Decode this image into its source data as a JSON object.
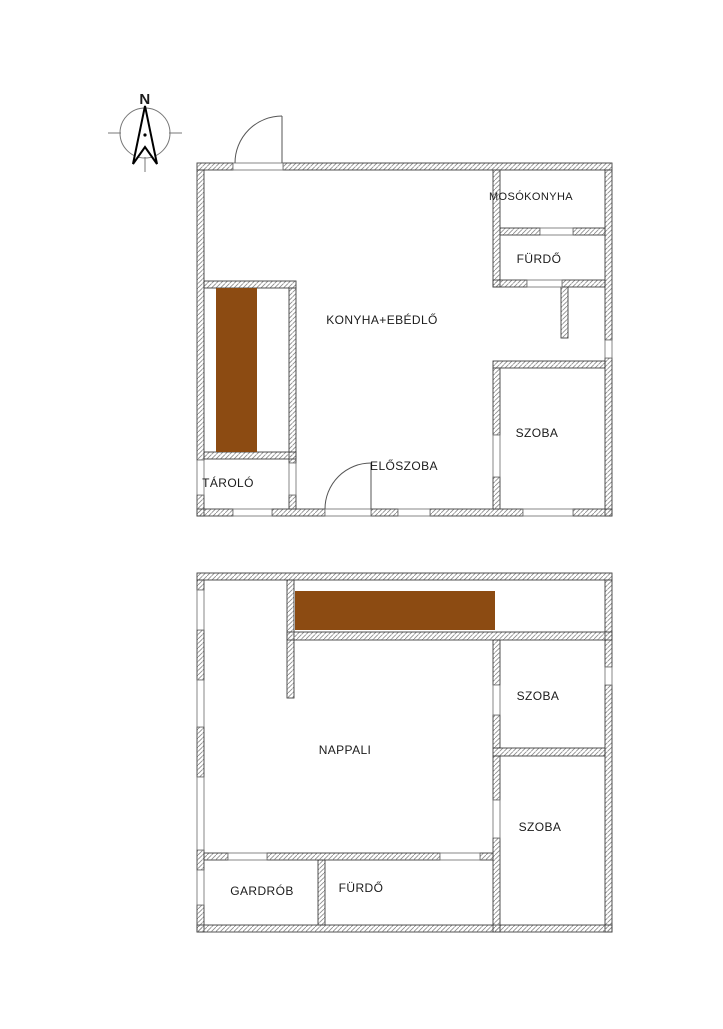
{
  "compass": {
    "north_label": "N"
  },
  "colors": {
    "stairs": "#8c4b12",
    "wall_line": "#3f3f3f",
    "hatch_line": "#8a8a8a",
    "text": "#1b1b1b"
  },
  "floor1": {
    "rooms": {
      "kitchen_dining": "KONYHA+EBÉDLŐ",
      "laundry": "MOSÓKONYHA",
      "bathroom": "FÜRDŐ",
      "room": "SZOBA",
      "storage": "TÁROLÓ",
      "hallway": "ELŐSZOBA"
    }
  },
  "floor2": {
    "rooms": {
      "living_room": "NAPPALI",
      "room_upper": "SZOBA",
      "room_lower": "SZOBA",
      "wardrobe": "GARDRÓB",
      "bathroom": "FÜRDŐ"
    }
  }
}
